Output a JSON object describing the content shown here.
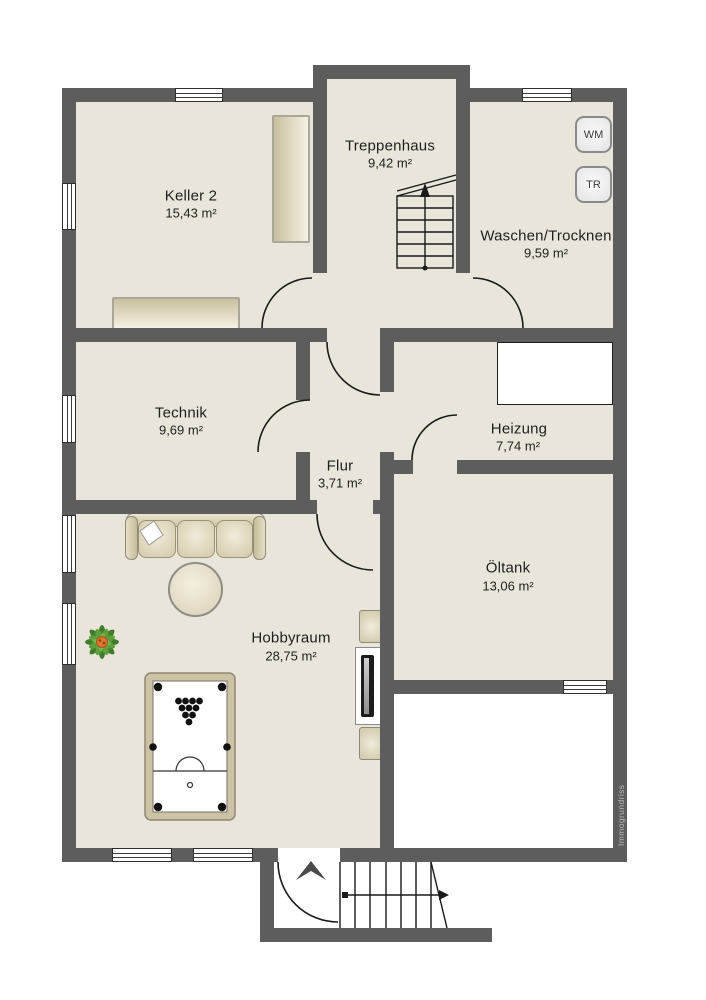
{
  "watermark": "Immogrundriss",
  "colors": {
    "wall": "#5d5d5d",
    "floor": "#e9e5da",
    "exterior_room": "#ffffff",
    "furniture_beige": "#d6cdad",
    "plant_green": "#4c8a33",
    "plant_center_orange": "#d9772e",
    "line_dark": "#1a1a1a"
  },
  "rooms": [
    {
      "name": "Keller 2",
      "area": "15,43 m²"
    },
    {
      "name": "Treppenhaus",
      "area": "9,42 m²"
    },
    {
      "name": "Waschen/Trocknen",
      "area": "9,59 m²"
    },
    {
      "name": "Technik",
      "area": "9,69 m²"
    },
    {
      "name": "Flur",
      "area": "3,71 m²"
    },
    {
      "name": "Heizung",
      "area": "7,74 m²"
    },
    {
      "name": "Öltank",
      "area": "13,06 m²"
    },
    {
      "name": "Hobbyraum",
      "area": "28,75 m²"
    }
  ],
  "appliances": {
    "washing_machine": "WM",
    "dryer": "TR"
  }
}
